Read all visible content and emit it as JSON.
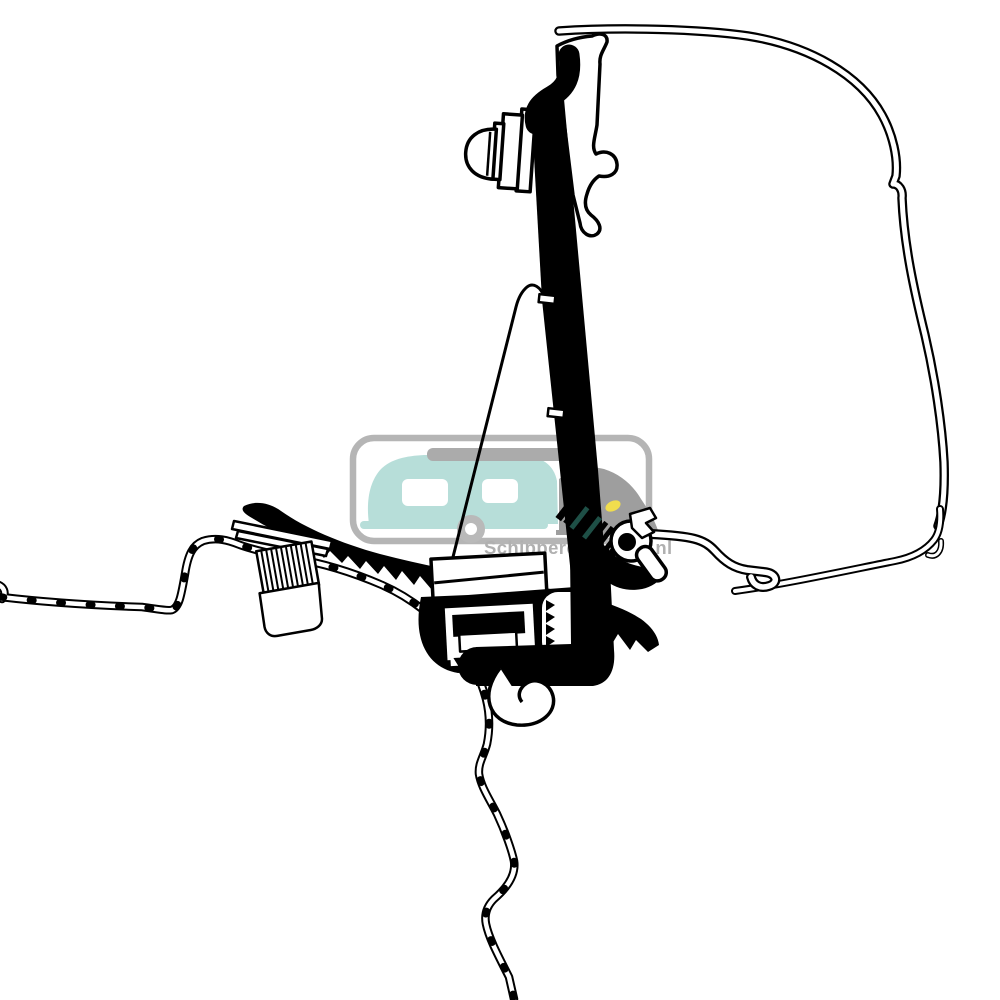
{
  "watermark": {
    "text": "Schippercaravans.nl"
  },
  "colors": {
    "line": "#000000",
    "background": "#ffffff",
    "watermark_grey": "#b5b5b5",
    "text_grey": "#b0b0b0",
    "caravan_teal": "#b7ded9",
    "roofbox_grey": "#ababab",
    "car_grey": "#9e9e9e",
    "wheel_grey": "#b9b9b9",
    "headlight_yellow": "#f0dd4e",
    "screw_teal": "#1e4f46"
  }
}
